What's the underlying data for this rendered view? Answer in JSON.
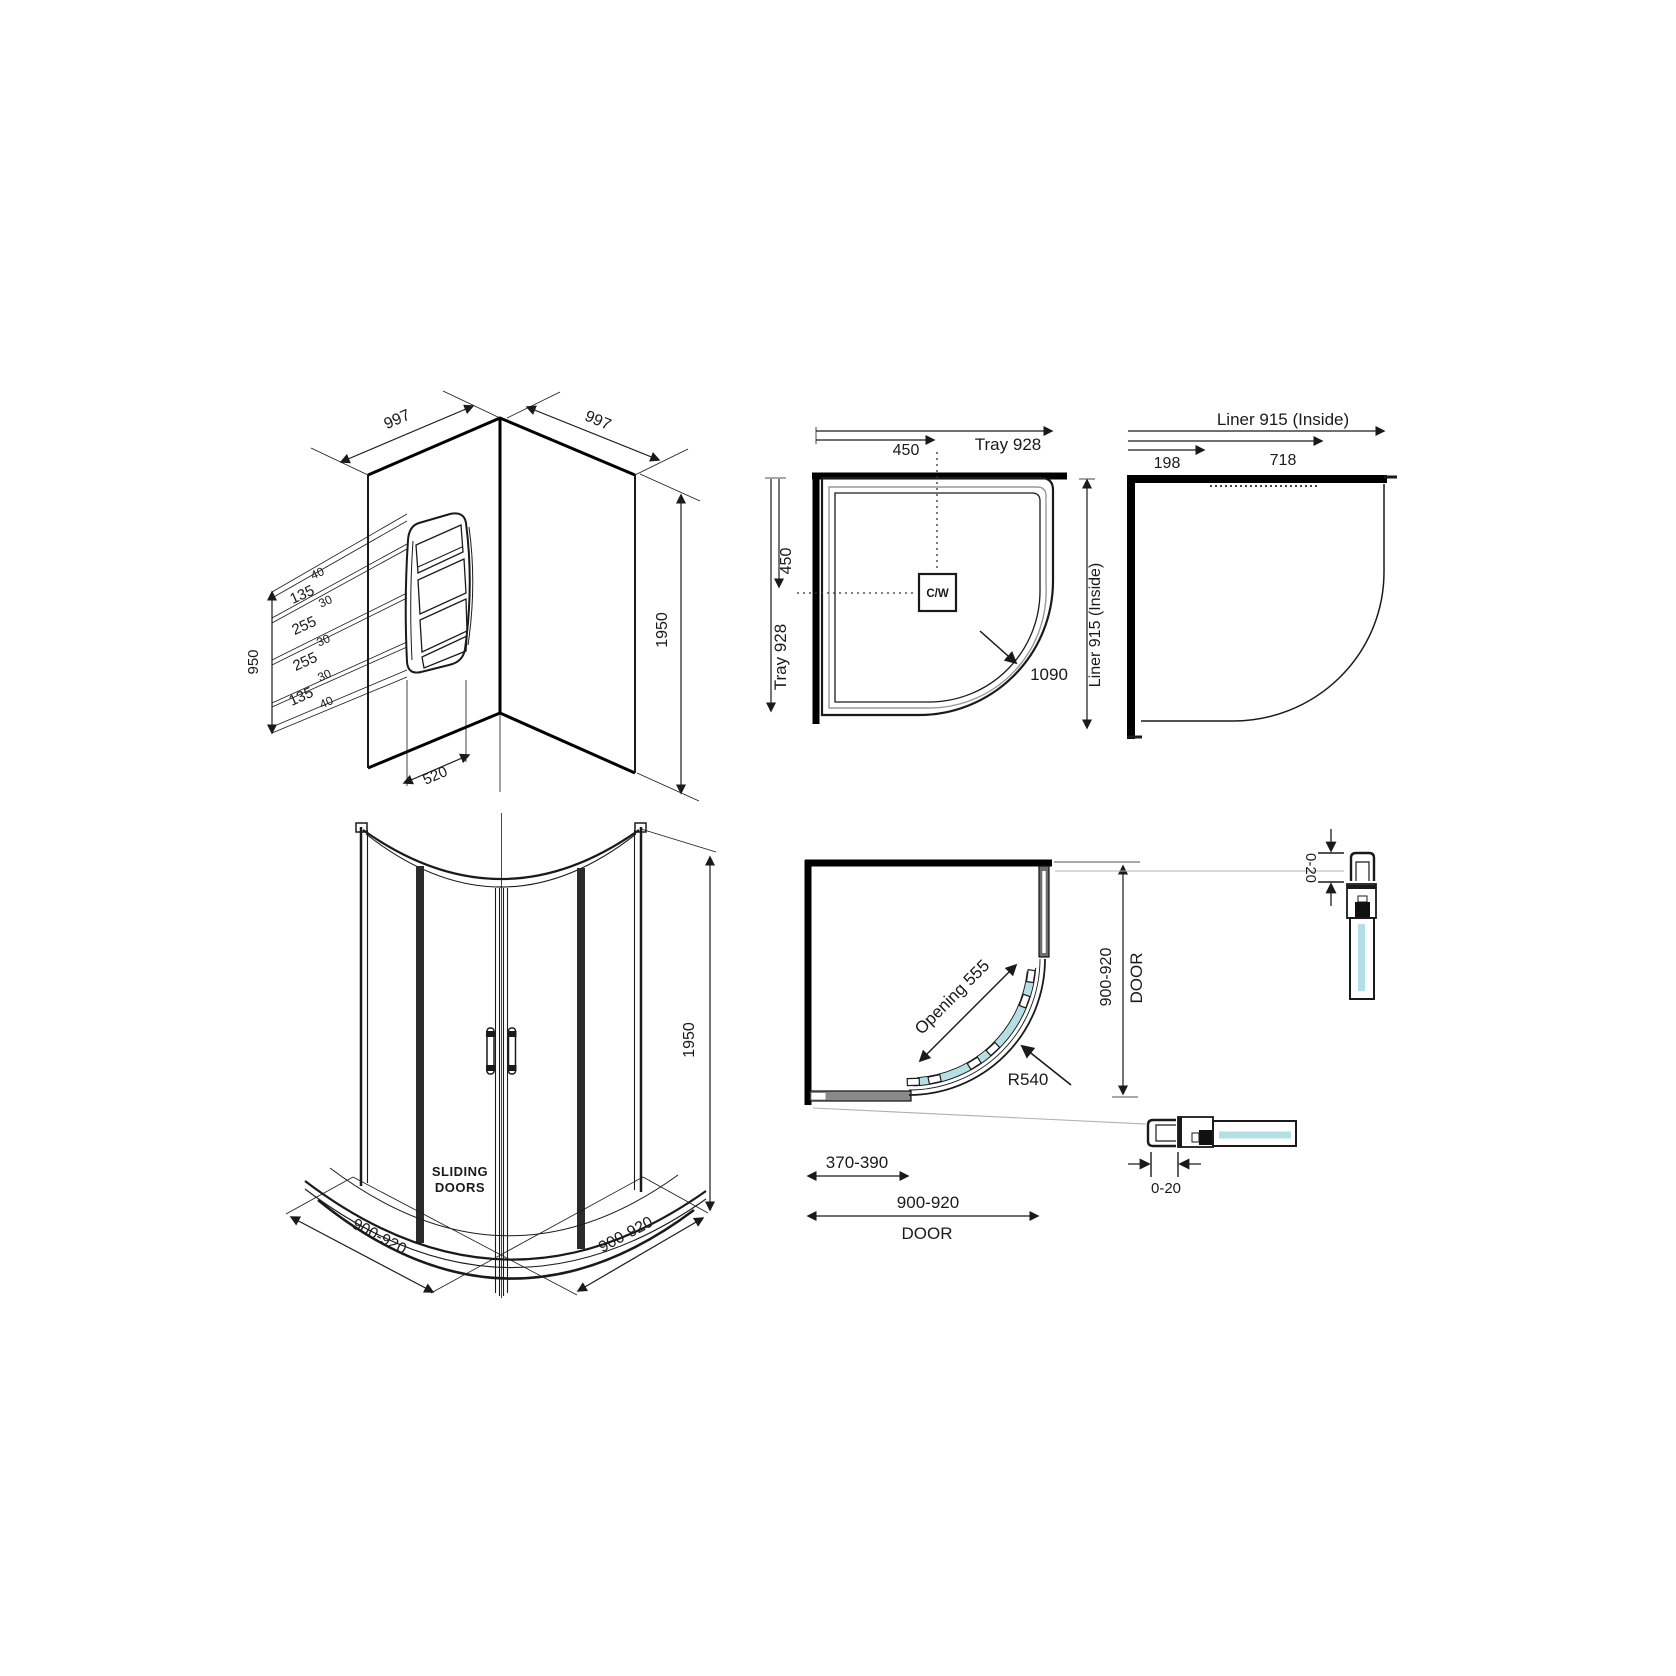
{
  "colors": {
    "glass": "#b2e0e5",
    "line": "#1a1a1a",
    "wall": "#000000",
    "rim": "#999999",
    "profile_fill": "#6e6e6e",
    "rail_fill": "#8a8a8a"
  },
  "panels": {
    "corner_walls": {
      "width_left": "997",
      "width_right": "997",
      "height": "1950",
      "stack_total": "950",
      "shelf_width": "520",
      "segments": [
        "40",
        "135",
        "30",
        "255",
        "30",
        "255",
        "30",
        "135",
        "40"
      ]
    },
    "tray_plan": {
      "top_offset": "450",
      "top_total": "Tray 928",
      "side_offset": "450",
      "side_total": "Tray 928",
      "centre_waste": "C/W",
      "diagonal": "1090"
    },
    "liner_plan": {
      "top_total": "Liner 915 (Inside)",
      "side_total": "Liner 915 (Inside)",
      "seg_short": "198",
      "seg_long": "718"
    },
    "enclosure_3d": {
      "door_label_1": "SLIDING",
      "door_label_2": "DOORS",
      "height": "1950",
      "width_left": "900-920",
      "width_right": "900-920"
    },
    "door_plan": {
      "opening": "Opening 555",
      "radius": "R540",
      "side_width": "900-920",
      "side_label": "DOOR",
      "panel_width": "370-390",
      "bottom_width": "900-920",
      "bottom_label": "DOOR"
    },
    "details": {
      "top_adjust": "0-20",
      "bottom_adjust": "0-20"
    }
  }
}
